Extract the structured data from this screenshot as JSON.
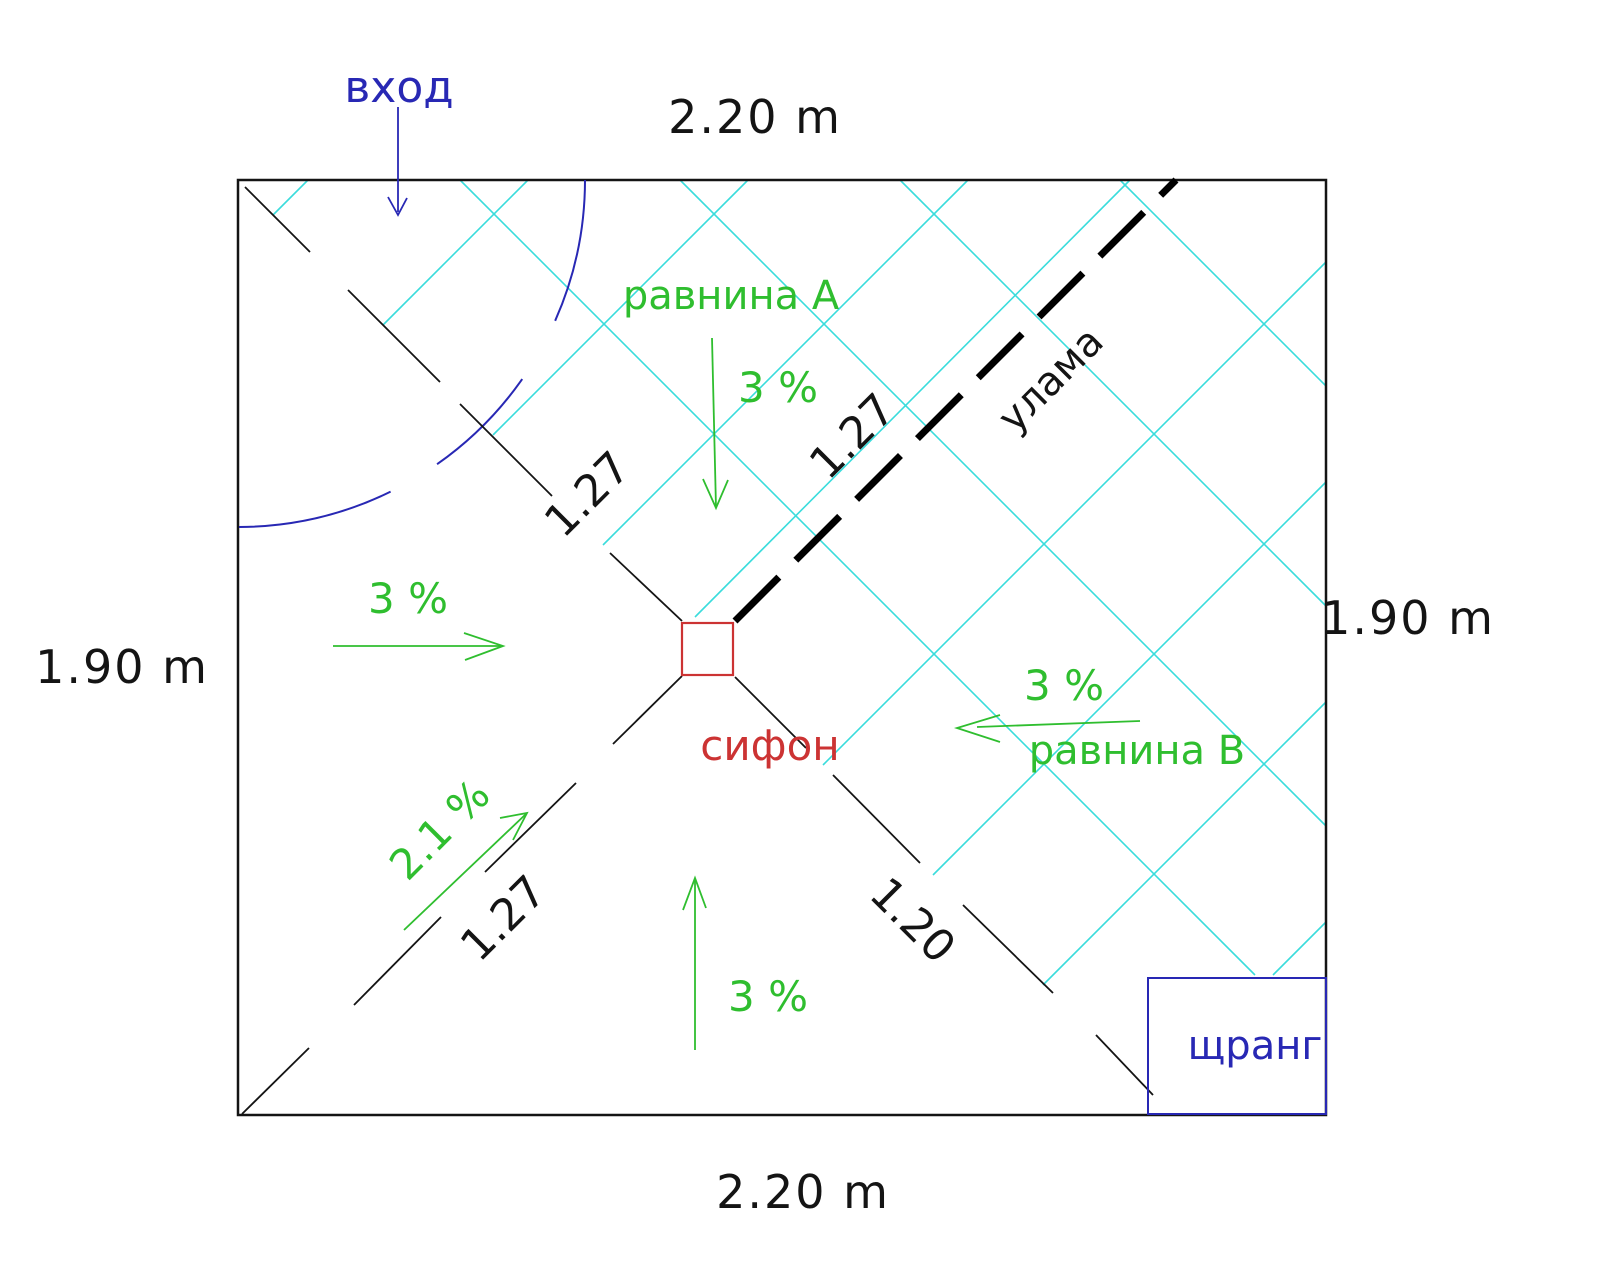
{
  "colors": {
    "ink": "#141414",
    "cyan": "#3adcdc",
    "green": "#2fbe2f",
    "blue": "#2828b4",
    "red": "#cc3333"
  },
  "dimensions": {
    "top": "2.20 m",
    "bottom": "2.20 m",
    "left": "1.90 m",
    "right": "1.90 m"
  },
  "labels": {
    "entrance": "вход",
    "plane_a": "равнина А",
    "plane_b": "равнина В",
    "valley": "улама",
    "drain": "сифон",
    "riser": "щранг"
  },
  "slopes": {
    "plane_a": "3 %",
    "plane_b": "3 %",
    "left": "3 %",
    "bottom": "3 %",
    "diagonal": "2.1 %"
  },
  "lengths": {
    "top_left": "1.27",
    "valley": "1.27",
    "bottom_left": "1.27",
    "bottom_right": "1.20"
  }
}
